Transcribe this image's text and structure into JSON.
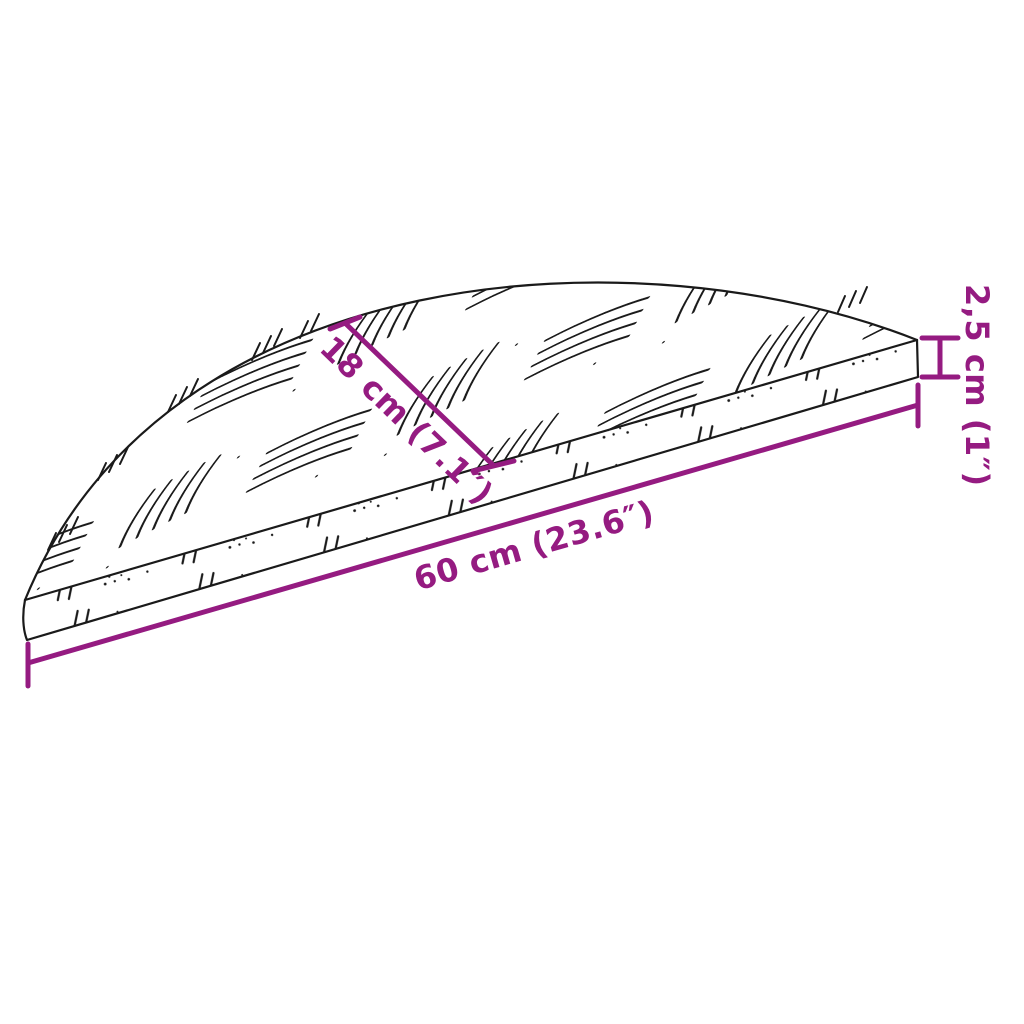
{
  "labels": {
    "depth": "18 cm (7.1″)",
    "width": "60 cm (23.6″)",
    "thickness": "2,5 cm (1″)"
  },
  "colors": {
    "dimension": "#951B81",
    "line_art": "#1A1A1A",
    "background": "#FFFFFF"
  }
}
